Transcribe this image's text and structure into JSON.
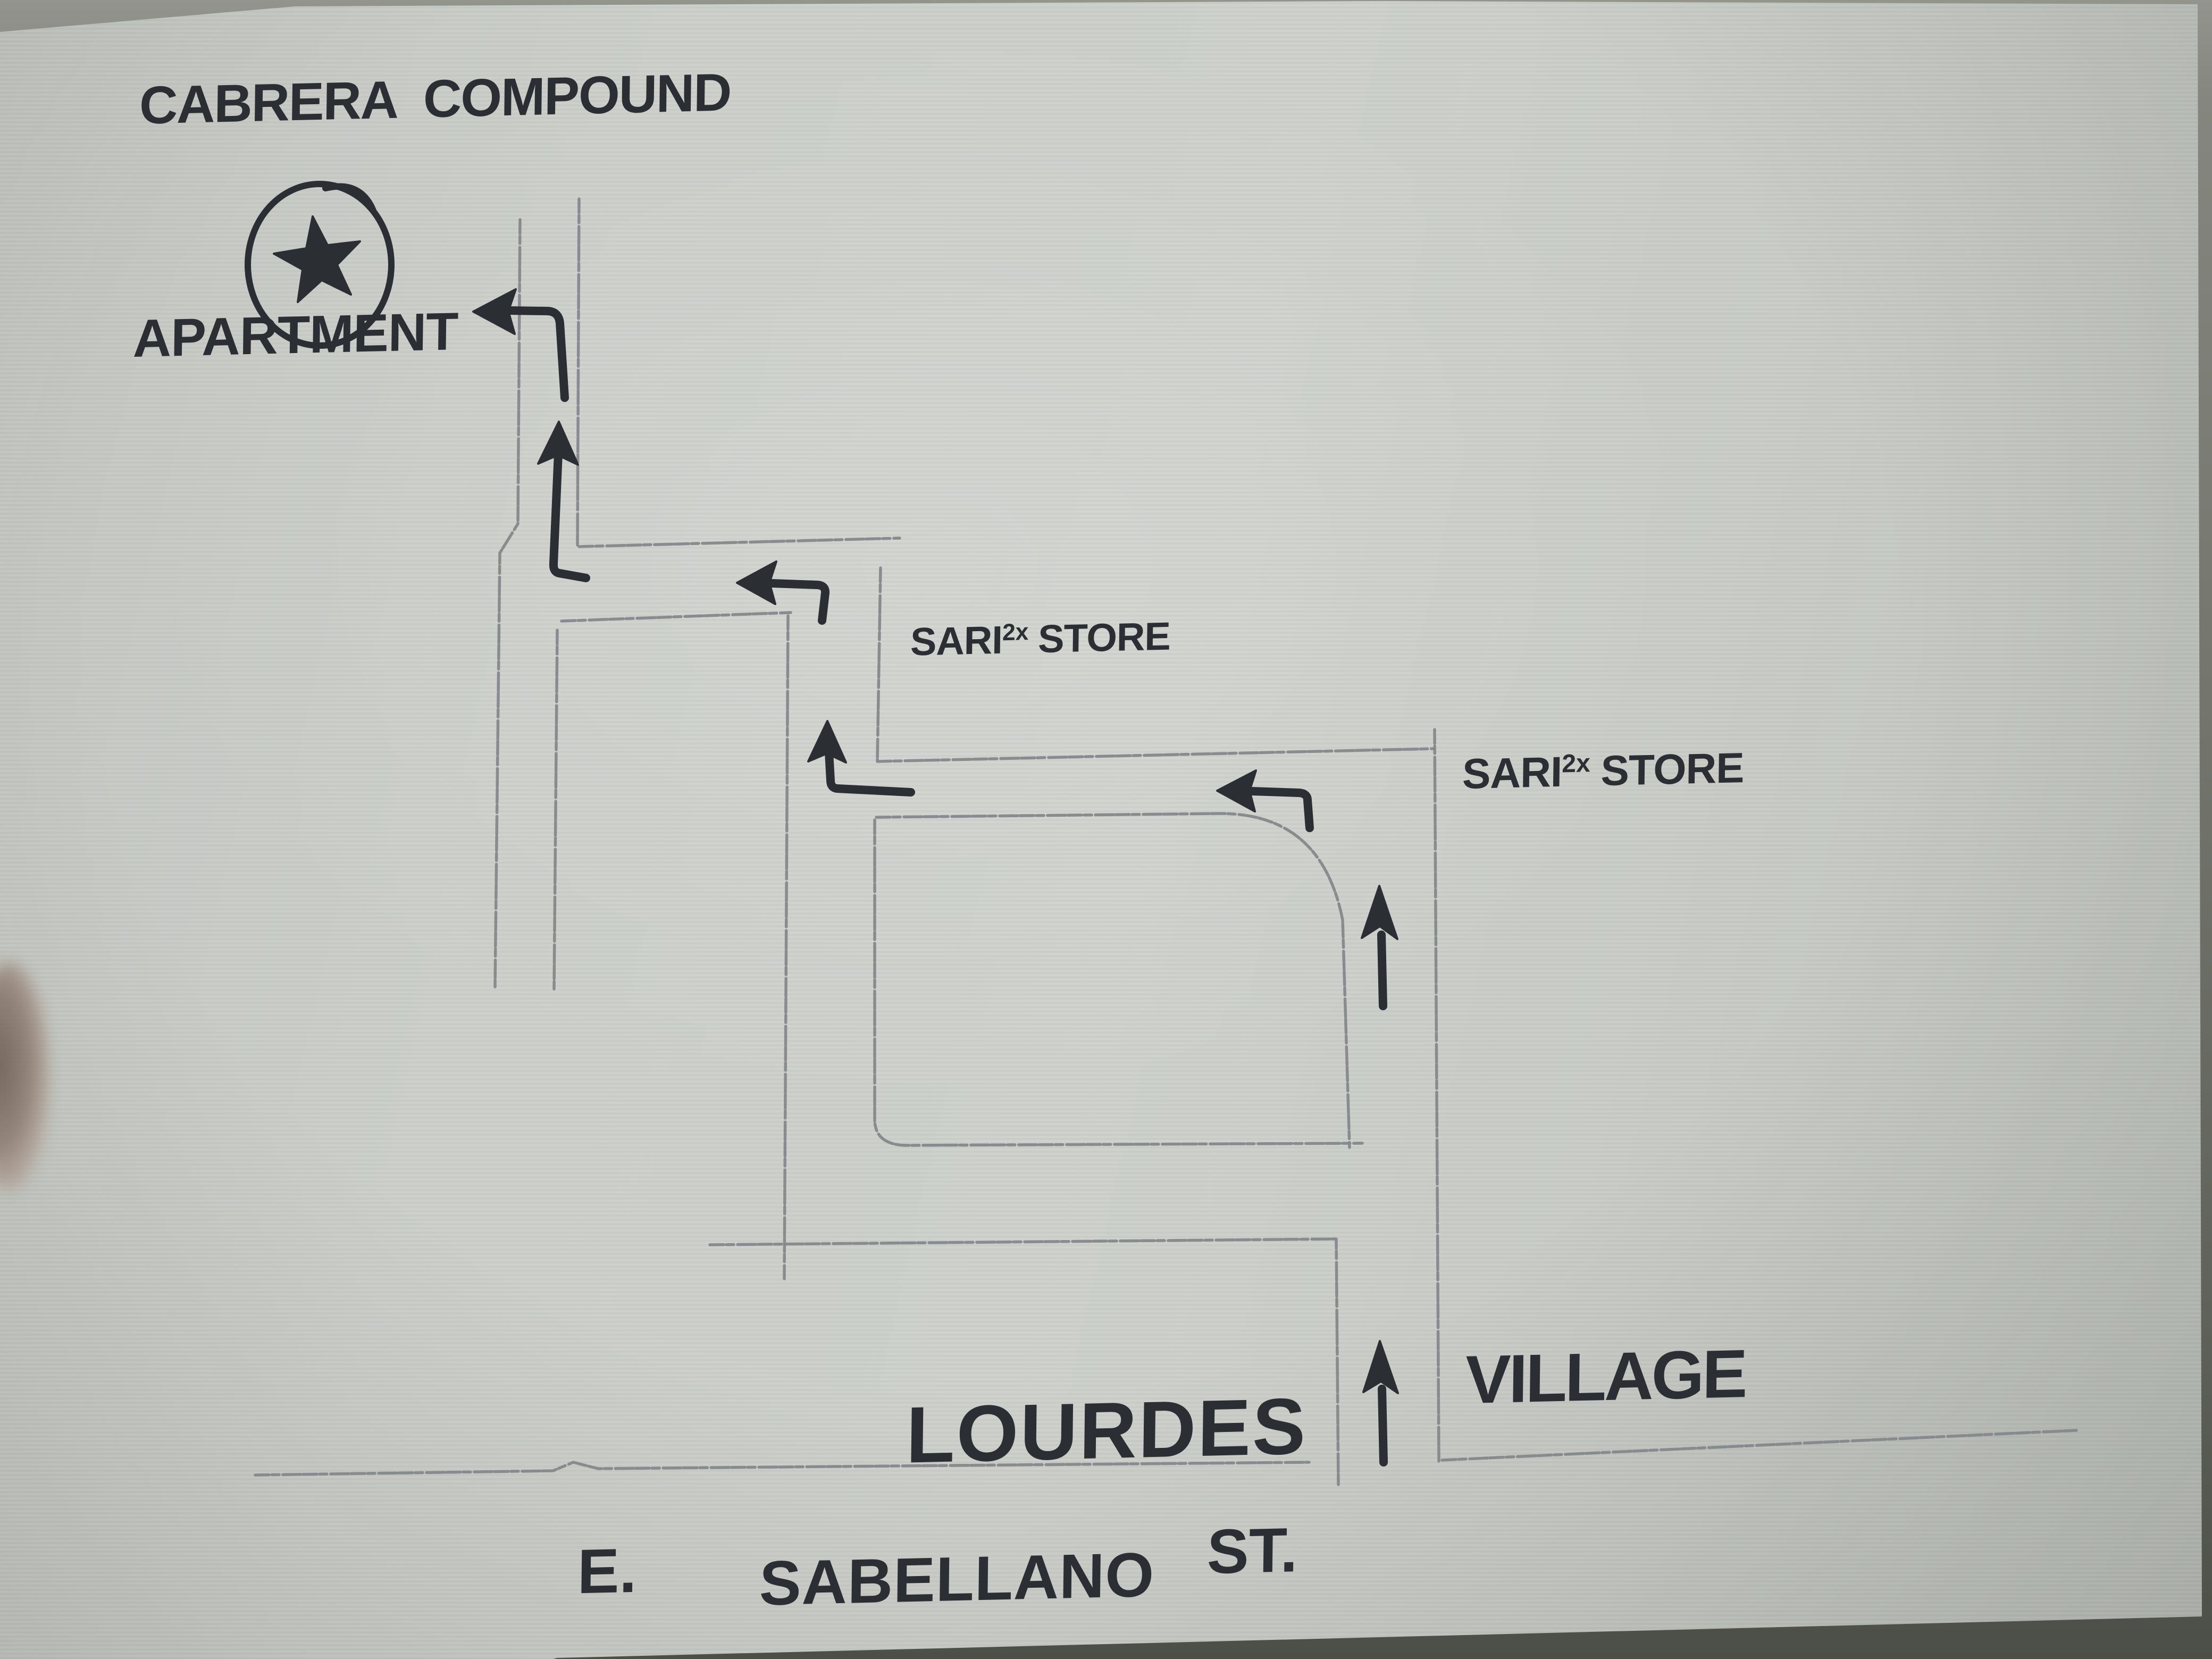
{
  "map": {
    "type": "hand-drawn directions sketch on paper",
    "title": "CABRERA COMPOUND",
    "destination": {
      "label": "APARTMENT",
      "marker": "star-in-circle"
    },
    "landmarks": {
      "sari_store_1": {
        "word1": "SARI",
        "sup": "2x",
        "word2": "STORE"
      },
      "sari_store_2": {
        "word1": "SARI",
        "sup": "2x",
        "word2": "STORE"
      },
      "lourdes": "LOURDES",
      "village": "VILLAGE"
    },
    "street": {
      "prefix": "E.",
      "name": "SABELLANO",
      "suffix": "ST."
    },
    "route_arrows": [
      "up from E. Sabellano St. between Lourdes and Village",
      "up past the block",
      "left onto second street at Sari 2x Store corner",
      "up at west end of second street",
      "left onto first street toward apartment road",
      "up along apartment road",
      "left into Cabrera Compound apartment"
    ],
    "colors": {
      "paper": "#cbcec9",
      "ink": "#2b2e33",
      "pencil": "#85888b",
      "background": "#60635b"
    }
  }
}
